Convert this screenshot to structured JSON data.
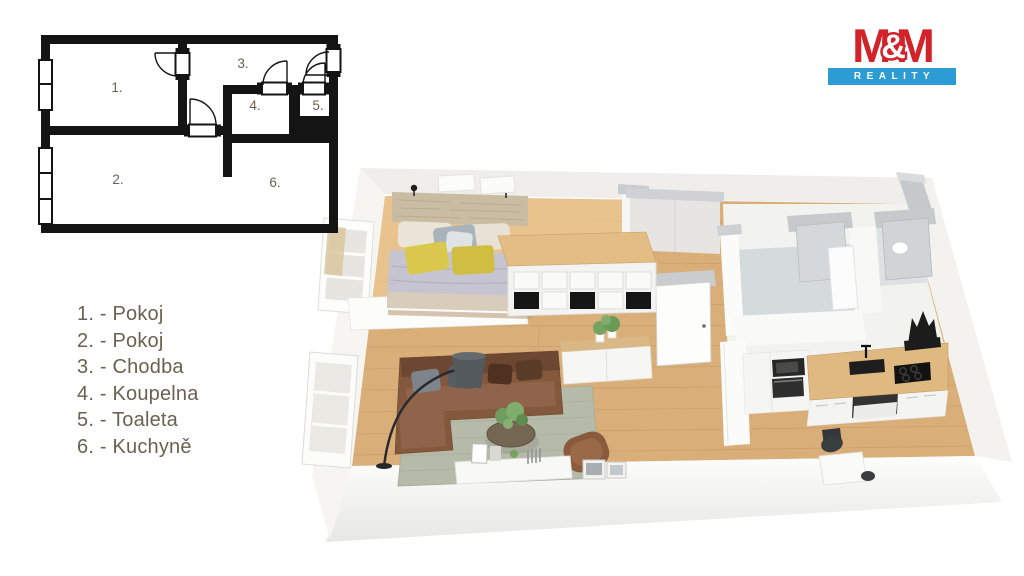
{
  "logo": {
    "m1": "M",
    "amp": "&",
    "m2": "M",
    "reality": "REALITY",
    "brand_red": "#d2232a",
    "brand_blue": "#2d9bd4"
  },
  "legend": {
    "text_color": "#6b6150",
    "items": [
      {
        "text": "1. - Pokoj"
      },
      {
        "text": "2. - Pokoj"
      },
      {
        "text": "3. - Chodba"
      },
      {
        "text": "4. - Koupelna"
      },
      {
        "text": "5. - Toaleta"
      },
      {
        "text": "6. - Kuchyně"
      }
    ]
  },
  "plan2d": {
    "wall_color": "#141414",
    "label_color": "#6b6150",
    "labels": [
      {
        "text": "1."
      },
      {
        "text": "2."
      },
      {
        "text": "3."
      },
      {
        "text": "4."
      },
      {
        "text": "5."
      },
      {
        "text": "6."
      }
    ]
  },
  "plan3d": {
    "palette": {
      "floor_wood": "#d9ae78",
      "floor_wood_light": "#ecca96",
      "wall_white": "#f4f4f1",
      "wall_cap_gray": "#c6cacc",
      "bathroom_floor": "#d5dadd",
      "counter_wood": "#dfb97f",
      "sofa_brown": "#83583d",
      "rug_gray_green": "#b6baa9",
      "bed_duvet": "#c6c4d1",
      "accent_yellow": "#d9c84b",
      "plant_green": "#76a361",
      "appliance_dark": "#262626"
    }
  }
}
